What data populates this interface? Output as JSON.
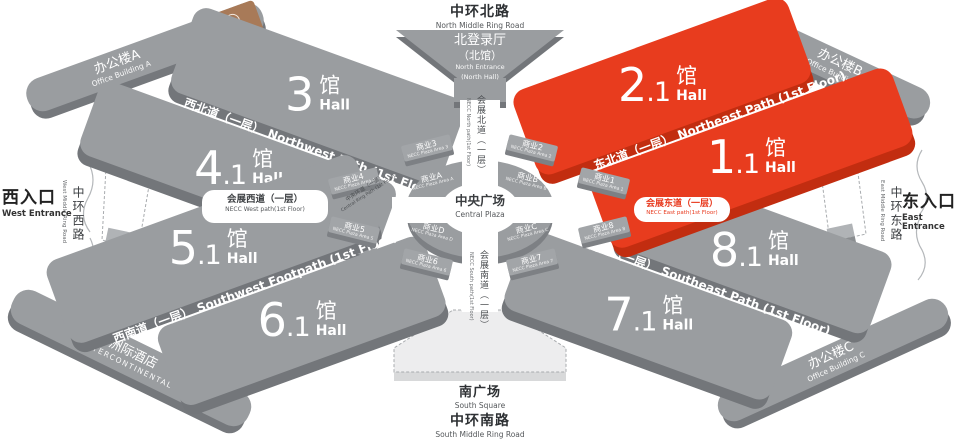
{
  "colors": {
    "hall_gray": "#9a9da0",
    "hall_gray_side": "#73767a",
    "hall_red": "#e83c1e",
    "hall_red_side": "#c22d10",
    "brown_badge": "#a87a58",
    "east_path_text": "#e8391d"
  },
  "icons": {
    "necc_logo": "necc-logo"
  },
  "halls": [
    {
      "num": "3",
      "sub": "",
      "cn": "馆",
      "en": "Hall"
    },
    {
      "num": "4",
      "sub": ".1",
      "cn": "馆",
      "en": "Hall"
    },
    {
      "num": "2",
      "sub": ".1",
      "cn": "馆",
      "en": "Hall"
    },
    {
      "num": "1",
      "sub": ".1",
      "cn": "馆",
      "en": "Hall"
    },
    {
      "num": "5",
      "sub": ".1",
      "cn": "馆",
      "en": "Hall"
    },
    {
      "num": "6",
      "sub": ".1",
      "cn": "馆",
      "en": "Hall"
    },
    {
      "num": "8",
      "sub": ".1",
      "cn": "馆",
      "en": "Hall"
    },
    {
      "num": "7",
      "sub": ".1",
      "cn": "馆",
      "en": "Hall"
    }
  ],
  "paths": {
    "nw": {
      "zh": "西北道（一层）",
      "en": "Northwest Path (1st Floor)"
    },
    "ne": {
      "zh": "东北道（一层）",
      "en": "Northeast Path (1st Floor)"
    },
    "sw": {
      "zh": "西南道（一层）",
      "en": "Southwest Footpath (1st Floor)"
    },
    "se": {
      "zh": "东南道（一层）",
      "en": "Southeast Path (1st Floor)"
    }
  },
  "corridors": {
    "north": {
      "zh": "会展北道（一层）",
      "en": "NECC North path(1st Floor)"
    },
    "south": {
      "zh": "会展南道（一层）",
      "en": "NECC South path(1st Floor)"
    },
    "west": {
      "zh": "会展西道（一层）",
      "en": "NECC West path(1st Floor)"
    },
    "east": {
      "zh": "会展东道（一层）",
      "en": "NECC East path(1st Floor)"
    },
    "central": {
      "zh": "中央环道（一层）",
      "en": "Central Ring Path (1st Floor)"
    }
  },
  "roads": {
    "north": {
      "zh": "中环北路",
      "en": "North Middle Ring Road"
    },
    "south": {
      "zh": "中环南路",
      "en": "South Middle Ring Road"
    },
    "west": {
      "zh": "中环西路",
      "en": "West Middle Ring Road"
    },
    "east": {
      "zh": "中环东路",
      "en": "East Middle Ring Road"
    }
  },
  "entrances": {
    "west": {
      "zh": "西入口",
      "en": "West Entrance"
    },
    "east": {
      "zh": "东入口",
      "en": "East Entrance"
    },
    "north": {
      "zh1": "北登录厅",
      "zh2": "（北馆）",
      "en1": "North Entrance",
      "en2": "(North Hall)"
    }
  },
  "plaza": {
    "zh": "中央广场",
    "en": "Central Plaza"
  },
  "south_square": {
    "zh": "南广场",
    "en": "South Square"
  },
  "buildings": {
    "a": {
      "zh": "办公楼A",
      "en": "Office Building A"
    },
    "b": {
      "zh": "办公楼B",
      "en": "Office Building B"
    },
    "c": {
      "zh": "办公楼C",
      "en": "Office Building C"
    },
    "hotel": {
      "zh": "洲际酒店",
      "en": "INTERCONTINENTAL"
    }
  },
  "ring": {
    "sections": [
      {
        "zh": "商业A",
        "en": "NECC Plaza Area A"
      },
      {
        "zh": "商业B",
        "en": "NECC Plaza Area B"
      },
      {
        "zh": "商业C",
        "en": "NECC Plaza Area C"
      },
      {
        "zh": "商业D",
        "en": "NECC Plaza Area D"
      }
    ],
    "blocks": [
      {
        "zh": "商业1",
        "en": "NECC Plaza Area 1"
      },
      {
        "zh": "商业2",
        "en": "NECC Plaza Area 2"
      },
      {
        "zh": "商业3",
        "en": "NECC Plaza Area 3"
      },
      {
        "zh": "商业4",
        "en": "NECC Plaza Area 4"
      },
      {
        "zh": "商业5",
        "en": "NECC Plaza Area 5"
      },
      {
        "zh": "商业6",
        "en": "NECC Plaza Area 6"
      },
      {
        "zh": "商业7",
        "en": "NECC Plaza Area 7"
      },
      {
        "zh": "商业8",
        "en": "NECC Plaza Area 8"
      }
    ]
  }
}
